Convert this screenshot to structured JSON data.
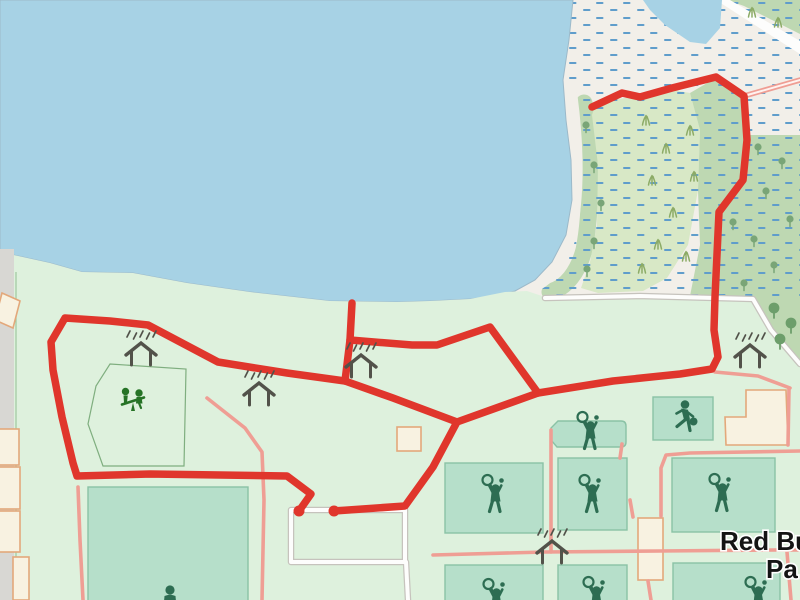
{
  "map": {
    "labels": {
      "place_line1": "Red Bu",
      "place_line2": "Pa"
    },
    "colors": {
      "water": "#a7d2e5",
      "water_dash": "#5f9dcb",
      "land": "#f2efe9",
      "park": "#def1dd",
      "park_line": "#a0c8a0",
      "shore": "#9cb9c9",
      "marsh_light": "#d8e8c6",
      "marsh_sage": "#bed8b2",
      "pitch": "#b6dfca",
      "pitch_border": "#8ac2a5",
      "building_fill": "#f8f2e1",
      "building_border": "#e3a87b",
      "route_red": "#e0362c",
      "path_pink": "#ef9e94",
      "path_white": "#fdfdfc",
      "path_casing": "#c6c3bd",
      "road_gray": "#d8d7d3",
      "icon_green": "#2d6d52",
      "playground_green": "#267326",
      "shelter_gray": "#52524a",
      "tree": "#79a577",
      "big_tree": "#6d9e6b",
      "grass": "#8cab66",
      "hex_border": "#7fae7f",
      "text": "#141414",
      "halo": "#ffffff"
    },
    "features": {
      "place_name_shown_partially": true,
      "route_endpoint_dots": 2,
      "picnic_shelter_icons": 5,
      "tennis_player_icons": 7,
      "basketball_player_icons": 1,
      "playground_seesaw_icons": 1,
      "sports_courts": 9,
      "icon_names": [
        "picnic-shelter-icon",
        "tennis-player-icon",
        "basketball-player-icon",
        "playground-seesaw-icon",
        "person-icon",
        "tree-icon",
        "grass-icon"
      ]
    }
  }
}
